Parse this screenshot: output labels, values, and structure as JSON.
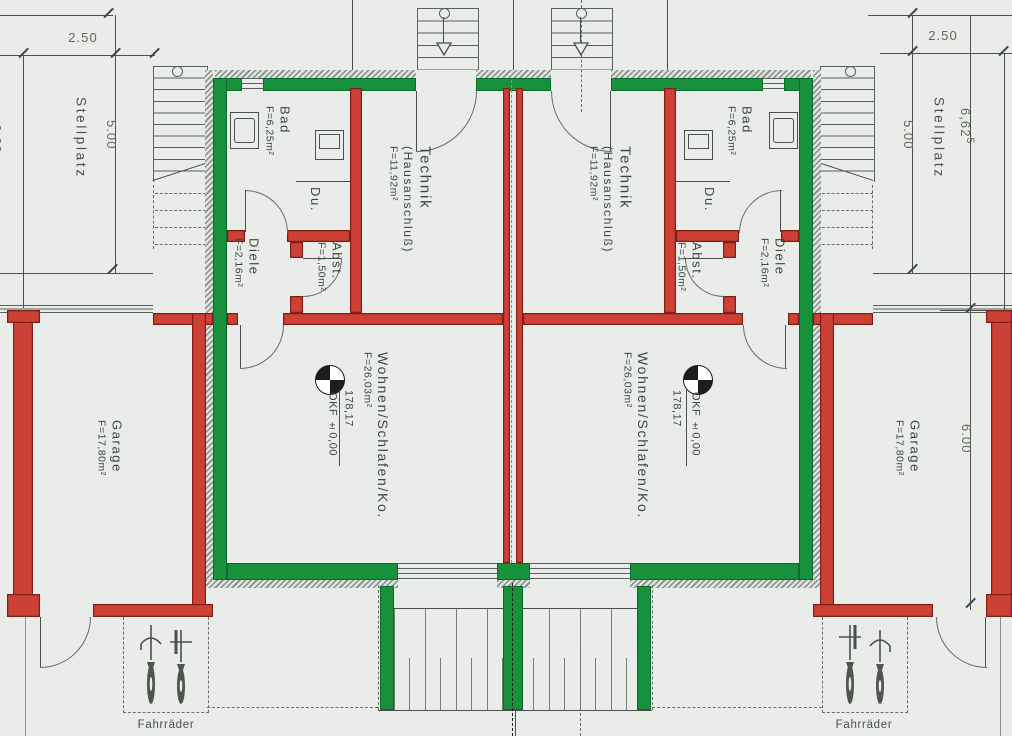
{
  "plan": {
    "rooms": {
      "bad": {
        "name": "Bad",
        "area": "F=6,25m²"
      },
      "technik": {
        "name": "Technik",
        "subname": "(Hausanschluß)",
        "area": "F=11,92m²"
      },
      "abstellraum": {
        "name": "Abst.",
        "area": "F=1,50m²"
      },
      "diele": {
        "name": "Diele",
        "area": "F=2,16m²"
      },
      "dusche": {
        "name": "Du."
      },
      "wohnen": {
        "name": "Wohnen/Schlafen/Ko.",
        "area": "F=26,03m²"
      },
      "garage": {
        "name": "Garage",
        "area": "F=17,80m²"
      },
      "stellplatz": {
        "name": "Stellplatz"
      },
      "fahrraeder": {
        "name": "Fahrräder"
      }
    },
    "levels": {
      "height_value": "178,17",
      "okf_label": "OKF ±0,00"
    },
    "dimensions": {
      "stellplatz_width": "2.50",
      "stellplatz_length": "5.00",
      "side_depth_base": "6,62",
      "side_depth_sup": "5",
      "garage_depth": "6.00",
      "left_clipped": "6,62"
    },
    "colors": {
      "exterior_wall": "#17913c",
      "interior_wall": "#cc4036",
      "paper": "#e9ece8",
      "line": "#4b504d"
    }
  }
}
